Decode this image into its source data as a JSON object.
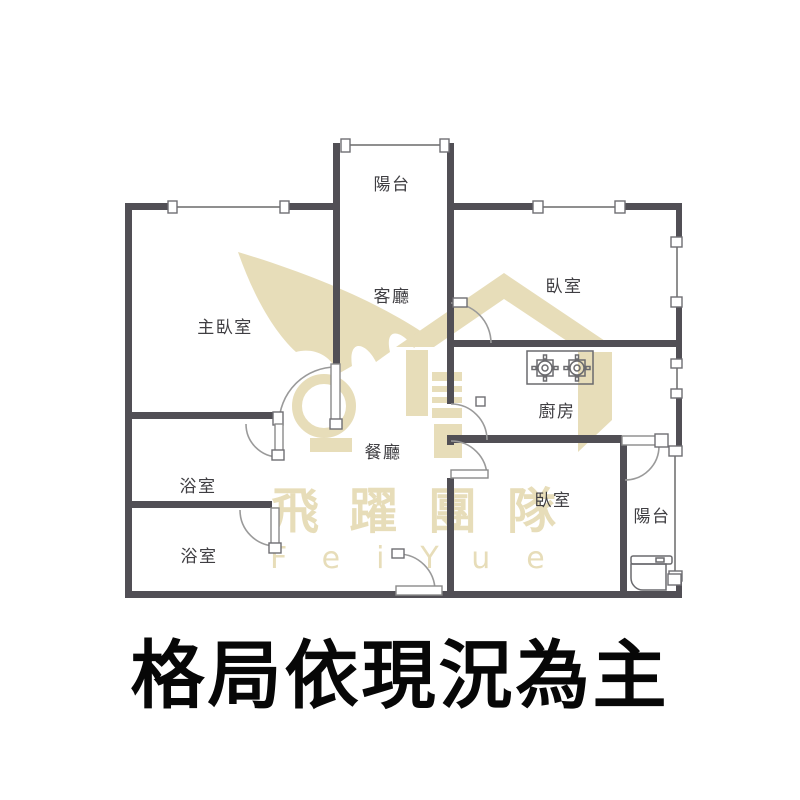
{
  "caption": "格局依現況為主",
  "watermark": {
    "brand_cjk": "飛躍團隊",
    "brand_latin": "FeiYue",
    "color": "#e7ddb9"
  },
  "plan": {
    "wall_color": "#514f55",
    "line_color": "#8f8f8f",
    "rooms": [
      {
        "id": "balcony-top",
        "label": "陽台"
      },
      {
        "id": "living-room",
        "label": "客廳"
      },
      {
        "id": "master-bedroom",
        "label": "主臥室"
      },
      {
        "id": "bedroom-top-right",
        "label": "臥室"
      },
      {
        "id": "kitchen",
        "label": "廚房"
      },
      {
        "id": "dining-room",
        "label": "餐廳"
      },
      {
        "id": "bathroom-upper",
        "label": "浴室"
      },
      {
        "id": "bathroom-lower",
        "label": "浴室"
      },
      {
        "id": "bedroom-bottom-right",
        "label": "臥室"
      },
      {
        "id": "balcony-bottom-right",
        "label": "陽台"
      }
    ]
  }
}
